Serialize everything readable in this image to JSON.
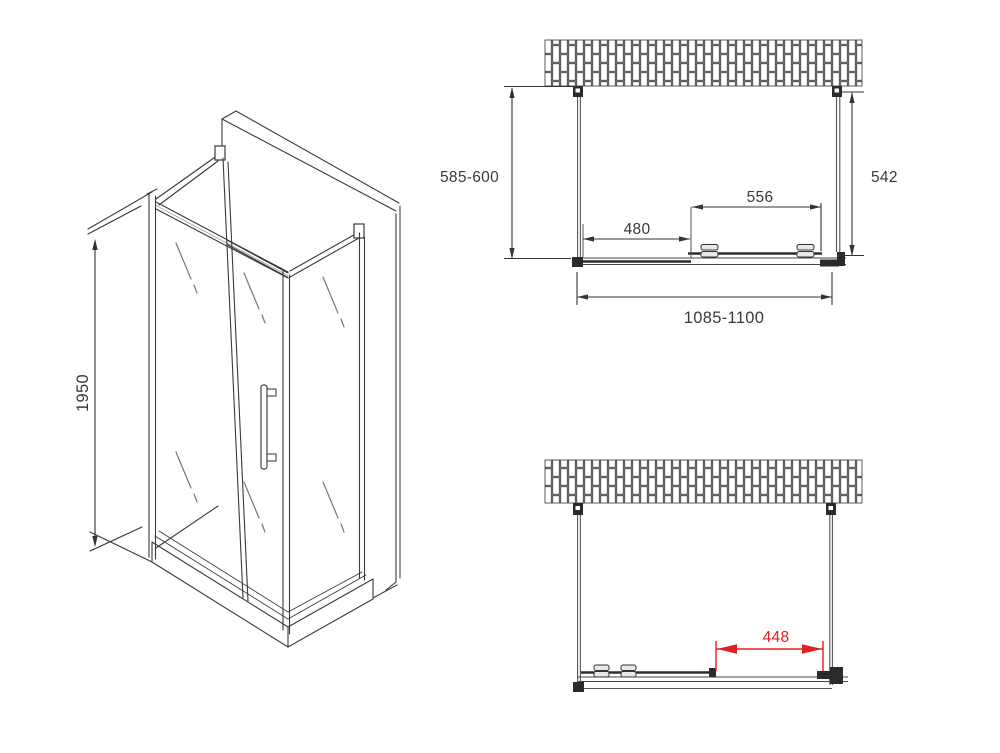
{
  "iso_view": {
    "height": "1950"
  },
  "top_view": {
    "side_depth": "585-600",
    "inner_depth": "542",
    "door_width": "556",
    "fixed_panel_width": "480",
    "total_width": "1085-1100"
  },
  "front_view": {
    "adjustment_width": "448"
  },
  "colors": {
    "line": "#3a3a3a",
    "glass_line": "#777777",
    "accent_red": "#e02020",
    "wall_joint": "#9e9e9e"
  }
}
